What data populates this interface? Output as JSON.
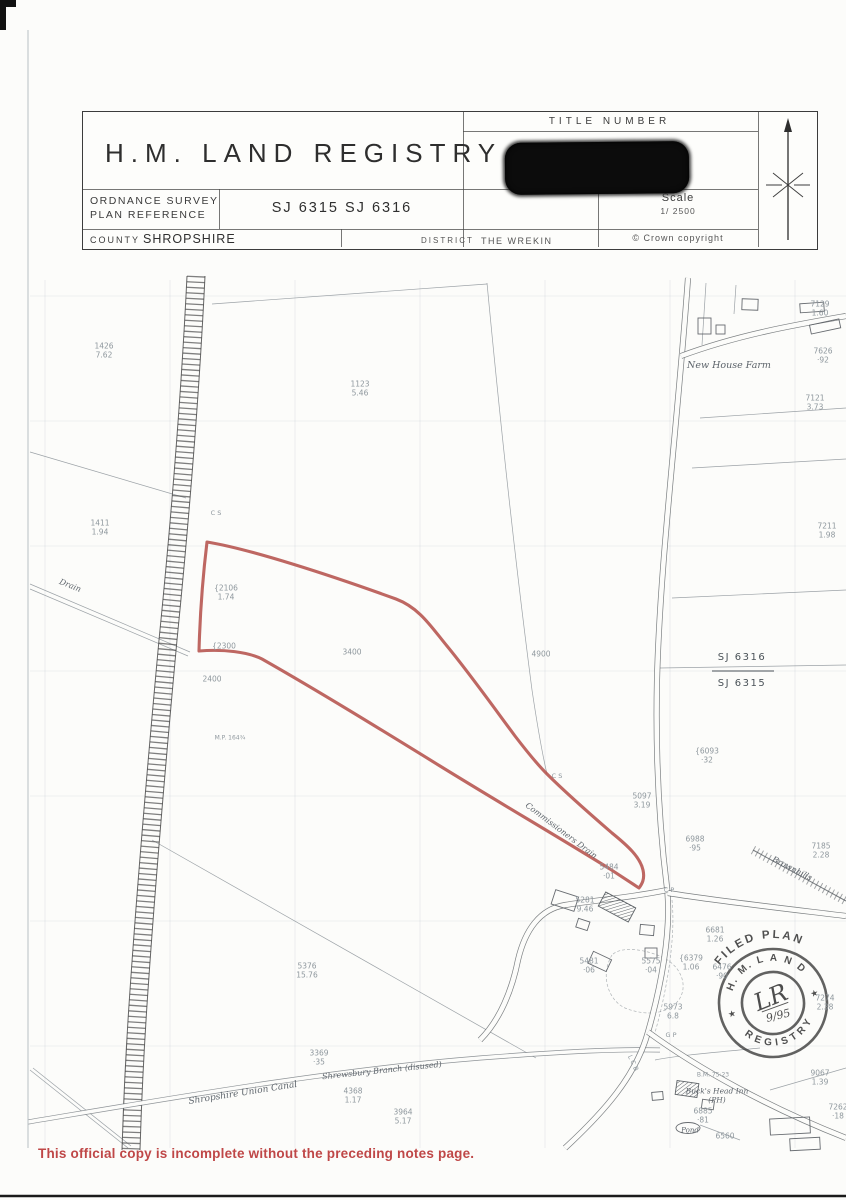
{
  "colors": {
    "boundary_red": "#b5524c",
    "footer_red": "#bf4747",
    "ink": "#3b3b3b"
  },
  "header": {
    "agency": "H.M.  LAND  REGISTRY",
    "title_number_label": "TITLE NUMBER",
    "title_number_redacted": true,
    "os_label_line1": "ORDNANCE SURVEY",
    "os_label_line2": "PLAN REFERENCE",
    "os_ref_value": "SJ 6315 SJ 6316",
    "scale_label": "Scale",
    "scale_value": "1/ 2500",
    "county_label": "COUNTY",
    "county_value": "SHROPSHIRE",
    "district_label": "DISTRICT",
    "district_value": "THE WREKIN",
    "copyright": "©  Crown copyright"
  },
  "map": {
    "labels": [
      {
        "t": [
          "1426",
          "7.62"
        ],
        "x": 104,
        "y": 351
      },
      {
        "t": [
          "1123",
          "5.46"
        ],
        "x": 360,
        "y": 389
      },
      {
        "t": [
          "1411",
          "1.94"
        ],
        "x": 100,
        "y": 528
      },
      {
        "t": [
          "C S"
        ],
        "x": 216,
        "y": 513,
        "s": 6.5
      },
      {
        "t": [
          "{2106",
          "1.74"
        ],
        "x": 226,
        "y": 593
      },
      {
        "t": [
          "{2300"
        ],
        "x": 224,
        "y": 646
      },
      {
        "t": [
          "2400"
        ],
        "x": 212,
        "y": 679
      },
      {
        "t": [
          "M.P. 164¾"
        ],
        "x": 230,
        "y": 738,
        "s": 6
      },
      {
        "t": [
          "3400"
        ],
        "x": 352,
        "y": 652
      },
      {
        "t": [
          "4900"
        ],
        "x": 541,
        "y": 654
      },
      {
        "t": [
          "7129",
          "1.60"
        ],
        "x": 820,
        "y": 309
      },
      {
        "t": [
          "7626",
          "·92"
        ],
        "x": 823,
        "y": 356
      },
      {
        "t": [
          "7121",
          "3.73"
        ],
        "x": 815,
        "y": 403
      },
      {
        "t": [
          "7211",
          "1.98"
        ],
        "x": 827,
        "y": 531
      },
      {
        "t": [
          "{6093",
          "·32"
        ],
        "x": 707,
        "y": 756
      },
      {
        "t": [
          "5097",
          "3.19"
        ],
        "x": 642,
        "y": 801
      },
      {
        "t": [
          "6988",
          "·95"
        ],
        "x": 695,
        "y": 844
      },
      {
        "t": [
          "7185",
          "2.28"
        ],
        "x": 821,
        "y": 851
      },
      {
        "t": [
          "6681",
          "1.26"
        ],
        "x": 715,
        "y": 935
      },
      {
        "t": [
          "{6379",
          "1.06"
        ],
        "x": 691,
        "y": 963
      },
      {
        "t": [
          "C P"
        ],
        "x": 669,
        "y": 890,
        "s": 6.5
      },
      {
        "t": [
          "5484",
          "·01"
        ],
        "x": 609,
        "y": 872
      },
      {
        "t": [
          "5281",
          "9.46"
        ],
        "x": 585,
        "y": 905
      },
      {
        "t": [
          "C S"
        ],
        "x": 557,
        "y": 776,
        "s": 6.5
      },
      {
        "t": [
          "5376",
          "15.76"
        ],
        "x": 307,
        "y": 971
      },
      {
        "t": [
          "3369",
          "·35"
        ],
        "x": 319,
        "y": 1058
      },
      {
        "t": [
          "4368",
          "1.17"
        ],
        "x": 353,
        "y": 1096
      },
      {
        "t": [
          "3964",
          "5.17"
        ],
        "x": 403,
        "y": 1117
      },
      {
        "t": [
          "5575",
          "·04"
        ],
        "x": 651,
        "y": 966
      },
      {
        "t": [
          "5481",
          "·06"
        ],
        "x": 589,
        "y": 966
      },
      {
        "t": [
          "5973",
          "6.8"
        ],
        "x": 673,
        "y": 1012
      },
      {
        "t": [
          "G P"
        ],
        "x": 671,
        "y": 1035,
        "s": 6.5
      },
      {
        "t": [
          "L C B"
        ],
        "x": 633,
        "y": 1063,
        "s": 6.5,
        "r": 65
      },
      {
        "t": [
          "B.M. 75·23"
        ],
        "x": 713,
        "y": 1075,
        "s": 6
      },
      {
        "t": [
          "6885",
          "·81"
        ],
        "x": 703,
        "y": 1116
      },
      {
        "t": [
          "6560"
        ],
        "x": 725,
        "y": 1136
      },
      {
        "t": [
          "9067",
          "1.39"
        ],
        "x": 820,
        "y": 1078
      },
      {
        "t": [
          "7262",
          "·18"
        ],
        "x": 838,
        "y": 1112
      },
      {
        "t": [
          "7274",
          "2.38"
        ],
        "x": 825,
        "y": 1003
      },
      {
        "t": [
          "6476",
          "·90"
        ],
        "x": 722,
        "y": 972
      },
      {
        "t": [
          "Drain"
        ],
        "x": 70,
        "y": 586,
        "c": "name",
        "r": 22,
        "s": 8
      },
      {
        "t": [
          "New House Farm"
        ],
        "x": 729,
        "y": 366,
        "c": "name",
        "s": 9.5
      },
      {
        "t": [
          "Brownhills"
        ],
        "x": 792,
        "y": 869,
        "c": "name",
        "r": 27,
        "s": 8
      },
      {
        "t": [
          "Commissioners Drain"
        ],
        "x": 561,
        "y": 831,
        "c": "name",
        "r": 37,
        "s": 8
      },
      {
        "t": [
          "Shropshire Union Canal"
        ],
        "x": 243,
        "y": 1094,
        "c": "name",
        "r": -9,
        "s": 9
      },
      {
        "t": [
          "Shrewsbury Branch (disused)"
        ],
        "x": 382,
        "y": 1071,
        "c": "name",
        "r": -6,
        "s": 8
      },
      {
        "t": [
          "Buck's Head Inn",
          "(PH)"
        ],
        "x": 717,
        "y": 1096,
        "c": "name",
        "s": 7.5
      },
      {
        "t": [
          "Pond"
        ],
        "x": 690,
        "y": 1131,
        "c": "name",
        "s": 7
      },
      {
        "t": [
          "SJ 6316"
        ],
        "x": 742,
        "y": 658,
        "c": "sheet"
      },
      {
        "t": [
          "SJ 6315"
        ],
        "x": 742,
        "y": 684,
        "c": "sheet"
      }
    ]
  },
  "stamp": {
    "arc_top": "FILED PLAN",
    "arc_land": "H. M.  L A N D",
    "arc_registry": "REGISTRY",
    "star": "★",
    "initials": "LR",
    "date": "9/95"
  },
  "footer": {
    "notice": "This official copy is incomplete without the preceding notes page."
  }
}
